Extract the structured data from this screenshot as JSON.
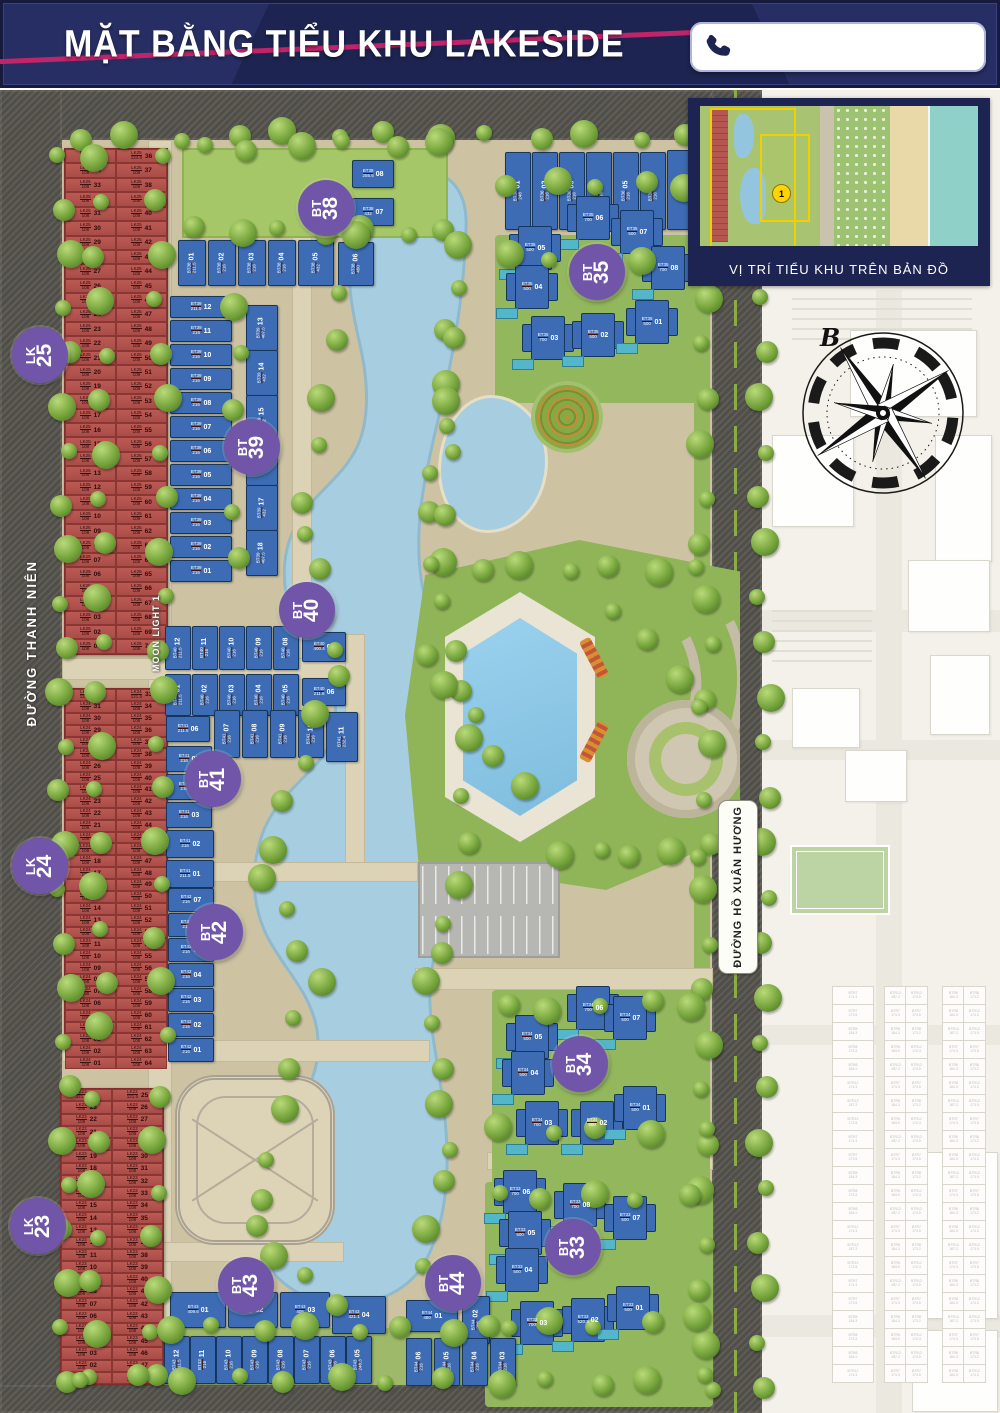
{
  "header": {
    "title": "MẶT BẰNG TIỂU KHU LAKESIDE",
    "phone_number": ""
  },
  "inset": {
    "caption": "VỊ TRÍ TIỂU KHU TRÊN BẢN ĐỒ",
    "marker": "1"
  },
  "compass": {
    "north_label": "B"
  },
  "streets": {
    "left_road": "ĐƯỜNG THANH NIÊN",
    "moonlight": "MOON LIGHT 1",
    "right_road": "ĐƯỜNG HỒ XUÂN HƯƠNG"
  },
  "colors": {
    "navy": "#1e2452",
    "stripe_pink": "#bf2568",
    "badge_purple": "#7155a8",
    "lot_red": "#b65651",
    "lot_blue": "#3d6cb4",
    "water": "#a7cde0"
  },
  "zones": {
    "lk_blocks": [
      {
        "id": "LK25",
        "badge": [
          "LK",
          "25"
        ],
        "code": "LK25",
        "area": "108",
        "corner_area": "124.6",
        "bottom_area": "108",
        "left_from": 35,
        "right_from": 36,
        "rows": 35,
        "lots_range": "01–70"
      },
      {
        "id": "LK24",
        "badge": [
          "LK",
          "24"
        ],
        "code": "LK24",
        "area": "108",
        "corner_area": "121.5",
        "bottom_area": "108",
        "left_from": 32,
        "right_from": 33,
        "rows": 32,
        "lots_range": "01–64"
      },
      {
        "id": "LK23",
        "badge": [
          "LK",
          "23"
        ],
        "code": "LK23",
        "area": "108",
        "corner_area": "121.5",
        "bottom_area": "137.5",
        "left_from": 24,
        "right_from": 25,
        "rows": 24,
        "lots_range": "01–48"
      }
    ],
    "villa_blocks": [
      {
        "id": "BT36",
        "lots": [
          {
            "n": "01",
            "a": "248"
          },
          {
            "n": "02",
            "a": "216"
          },
          {
            "n": "03",
            "a": "216"
          },
          {
            "n": "04",
            "a": "216"
          },
          {
            "n": "05",
            "a": "216"
          },
          {
            "n": "06",
            "a": "216"
          },
          {
            "n": "07",
            "a": "216"
          }
        ]
      },
      {
        "id": "BT38",
        "badge": [
          "BT",
          "38"
        ],
        "lots": [
          {
            "n": "01",
            "a": "211.5"
          },
          {
            "n": "02",
            "a": "216"
          },
          {
            "n": "03",
            "a": "216"
          },
          {
            "n": "04",
            "a": "216"
          },
          {
            "n": "05",
            "a": "432"
          },
          {
            "n": "06",
            "a": "450"
          },
          {
            "n": "07",
            "a": "432"
          },
          {
            "n": "08",
            "a": "255.6"
          }
        ]
      },
      {
        "id": "BT35",
        "badge": [
          "BT",
          "35"
        ],
        "lots": [
          {
            "n": "06",
            "a": "700"
          },
          {
            "n": "07",
            "a": "500"
          },
          {
            "n": "05",
            "a": "500"
          },
          {
            "n": "04",
            "a": "500"
          },
          {
            "n": "03",
            "a": "700"
          },
          {
            "n": "02",
            "a": "500"
          },
          {
            "n": "01",
            "a": "500"
          },
          {
            "n": "08",
            "a": "700"
          }
        ]
      },
      {
        "id": "BT39",
        "badge": [
          "BT",
          "39"
        ],
        "lots": [
          {
            "n": "12",
            "a": "211.5"
          },
          {
            "n": "11",
            "a": "216"
          },
          {
            "n": "10",
            "a": "216"
          },
          {
            "n": "09",
            "a": "216"
          },
          {
            "n": "08",
            "a": "216"
          },
          {
            "n": "07",
            "a": "216"
          },
          {
            "n": "06",
            "a": "216"
          },
          {
            "n": "05",
            "a": "216"
          },
          {
            "n": "04",
            "a": "216"
          },
          {
            "n": "03",
            "a": "216"
          },
          {
            "n": "02",
            "a": "216"
          },
          {
            "n": "01",
            "a": "216"
          },
          {
            "n": "13",
            "a": "407.5"
          },
          {
            "n": "14",
            "a": "432"
          },
          {
            "n": "15",
            "a": "432"
          },
          {
            "n": "16",
            "a": "432"
          },
          {
            "n": "17",
            "a": "432"
          },
          {
            "n": "18",
            "a": "407.5"
          }
        ]
      },
      {
        "id": "BT40",
        "badge": [
          "BT",
          "40"
        ],
        "lots": [
          {
            "n": "12",
            "a": "211.5"
          },
          {
            "n": "11",
            "a": "216"
          },
          {
            "n": "10",
            "a": "216"
          },
          {
            "n": "09",
            "a": "216"
          },
          {
            "n": "08",
            "a": "216"
          },
          {
            "n": "07",
            "a": "400.4"
          },
          {
            "n": "01",
            "a": "211.5"
          },
          {
            "n": "02",
            "a": "216"
          },
          {
            "n": "03",
            "a": "216"
          },
          {
            "n": "04",
            "a": "216"
          },
          {
            "n": "05",
            "a": "216"
          },
          {
            "n": "06",
            "a": "211.6"
          }
        ]
      },
      {
        "id": "BT41",
        "badge": [
          "BT",
          "41"
        ],
        "lots": [
          {
            "n": "06",
            "a": "211.5"
          },
          {
            "n": "07",
            "a": "216"
          },
          {
            "n": "08",
            "a": "216"
          },
          {
            "n": "09",
            "a": "216"
          },
          {
            "n": "10",
            "a": "216"
          },
          {
            "n": "11",
            "a": "232.4"
          },
          {
            "n": "05",
            "a": "216"
          },
          {
            "n": "04",
            "a": "216"
          },
          {
            "n": "03",
            "a": "216"
          },
          {
            "n": "02",
            "a": "216"
          },
          {
            "n": "01",
            "a": "211.5"
          }
        ]
      },
      {
        "id": "BT42",
        "badge": [
          "BT",
          "42"
        ],
        "lots": [
          {
            "n": "07",
            "a": "216"
          },
          {
            "n": "06",
            "a": "216"
          },
          {
            "n": "05",
            "a": "216"
          },
          {
            "n": "04",
            "a": "216"
          },
          {
            "n": "03",
            "a": "216"
          },
          {
            "n": "02",
            "a": "216"
          },
          {
            "n": "01",
            "a": "216"
          }
        ]
      },
      {
        "id": "BT34",
        "badge": [
          "BT",
          "34"
        ],
        "lots": [
          {
            "n": "06",
            "a": "700"
          },
          {
            "n": "07",
            "a": "500"
          },
          {
            "n": "05",
            "a": "500"
          },
          {
            "n": "04",
            "a": "500"
          },
          {
            "n": "03",
            "a": "700"
          },
          {
            "n": "02",
            "a": "500"
          },
          {
            "n": "01",
            "a": "500"
          }
        ]
      },
      {
        "id": "BT33",
        "badge": [
          "BT",
          "33"
        ],
        "lots": [
          {
            "n": "06",
            "a": "700"
          },
          {
            "n": "08",
            "a": "700"
          },
          {
            "n": "07",
            "a": "500"
          },
          {
            "n": "05",
            "a": "500"
          },
          {
            "n": "04",
            "a": "500"
          },
          {
            "n": "03",
            "a": "700"
          },
          {
            "n": "02",
            "a": "520.3"
          },
          {
            "n": "01",
            "a": "500"
          }
        ]
      },
      {
        "id": "BT43",
        "badge": [
          "BT",
          "43"
        ],
        "lots": [
          {
            "n": "01",
            "a": "409.6"
          },
          {
            "n": "02",
            "a": "405"
          },
          {
            "n": "03",
            "a": "405"
          },
          {
            "n": "04",
            "a": "421.1"
          },
          {
            "n": "12",
            "a": "211.5"
          },
          {
            "n": "11",
            "a": "216"
          },
          {
            "n": "10",
            "a": "216"
          },
          {
            "n": "09",
            "a": "216"
          },
          {
            "n": "08",
            "a": "216"
          },
          {
            "n": "07",
            "a": "216"
          },
          {
            "n": "06",
            "a": "216"
          },
          {
            "n": "05",
            "a": "248.3"
          }
        ]
      },
      {
        "id": "BT44",
        "badge": [
          "BT",
          "44"
        ],
        "lots": [
          {
            "n": "01",
            "a": "480"
          },
          {
            "n": "02",
            "a": "206"
          },
          {
            "n": "06",
            "a": "216"
          },
          {
            "n": "05",
            "a": "216"
          },
          {
            "n": "04",
            "a": "216"
          },
          {
            "n": "03",
            "a": "216"
          }
        ]
      }
    ]
  },
  "right_neighbor_lots": [
    "BTR7 174.3",
    "BTR7 173.5",
    "BTR8 184.3",
    "BTR8 173.2",
    "BTR8 184.9",
    "BTR12 174.3",
    "BTR12 187.2",
    "BTR12 173.5"
  ]
}
